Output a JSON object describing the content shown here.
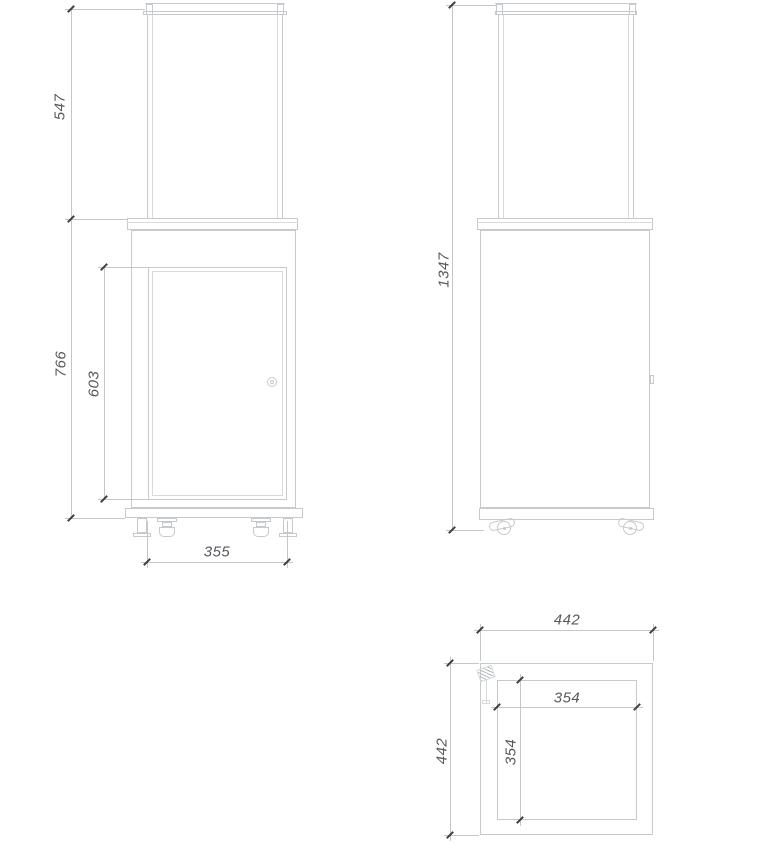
{
  "drawing": {
    "type": "technical-drawing",
    "views": {
      "front": {
        "dimensions": {
          "glass_height": "547",
          "body_height": "766",
          "door_height": "603",
          "door_width": "355"
        }
      },
      "side": {
        "dimensions": {
          "total_height": "1347"
        }
      },
      "top": {
        "dimensions": {
          "outer_width": "442",
          "outer_depth": "442",
          "inner_width": "354",
          "inner_depth": "354"
        }
      }
    },
    "colors": {
      "background": "#ffffff",
      "object_line": "#c6cacd",
      "light_line": "#d8dbde",
      "dim_line": "#c2c7cb",
      "tick": "#3a3e41",
      "text": "#565a5e"
    }
  }
}
